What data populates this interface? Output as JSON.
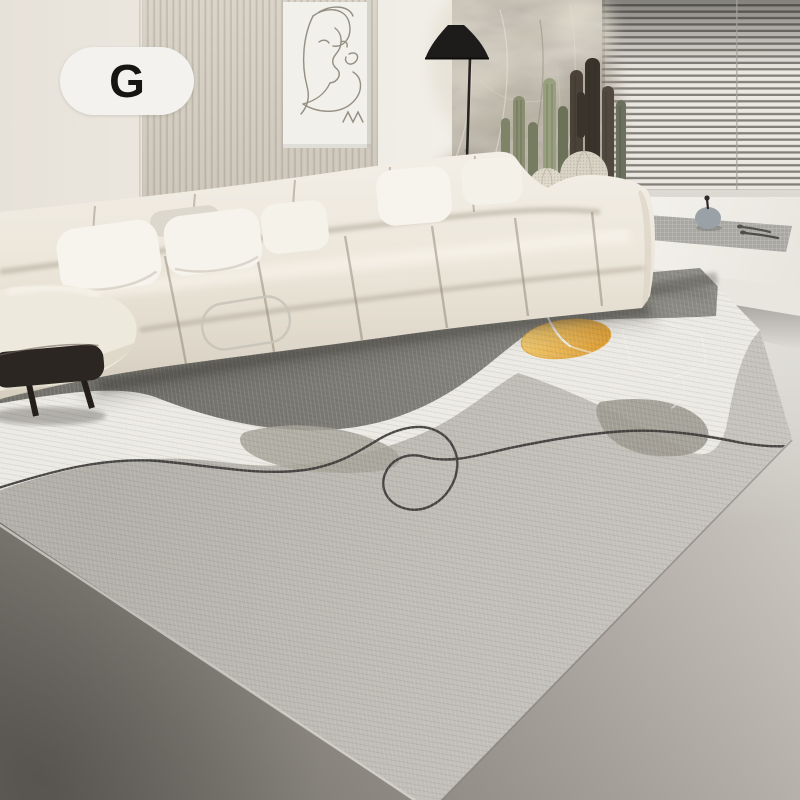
{
  "badge": {
    "label": "G",
    "background": "#f3f2ef",
    "text_color": "#171511"
  },
  "scene": {
    "description": "Minimalist living room product photo: cream modular sofa, large abstract gray area rug with mustard accent circle and black squiggle line, slatted wall panel with single-line portrait canvas, black cone floor lamp, pampas-grass wall hanging, cacti beside a window with horizontal blinds, white window bench with placemat and teapot",
    "wall": {
      "base": "#ece8e0",
      "slat_panel": "#dad4c9",
      "slat_line": "#c3bcb0",
      "seam": "#cfc9be"
    },
    "artwork": {
      "style": "single-line abstract portrait",
      "canvas": "#f2f0ea",
      "line": "#948e83"
    },
    "lamp": {
      "shade": "#1e1c1a",
      "pole": "#262422"
    },
    "blinds": {
      "light": "#ebe8e1",
      "dark": "#83807a"
    },
    "pampas": {
      "light": "#d8d1c2",
      "mid": "#b3ab9b",
      "dark": "#7a7365"
    },
    "cacti": {
      "green": "#8a8f72",
      "dark": "#3a332b",
      "gray_green": "#6b6f5e",
      "ball": "#d9d3c5"
    },
    "planter": {
      "color": "#efece5"
    },
    "bench": {
      "top": "#f4f2ed",
      "front": "#e9e6df",
      "placemat": "#a9a7a2",
      "teapot": "#9aa2a8",
      "cutlery": "#55534e"
    },
    "sofa": {
      "fabric": "#eee9dd",
      "highlight": "#f6f3ec",
      "shadow": "#d9d2c3",
      "pillow": "#f7f4ed"
    },
    "stool": {
      "color": "#2b2622"
    },
    "floor": {
      "light": "#dbd8d2",
      "mid": "#98948d",
      "dark": "#6b6862"
    },
    "rug": {
      "base": "#bcb9b2",
      "dark_section": "#75746d",
      "white_band": "#efede6",
      "accent_circle": "#e8a93c",
      "accent_circle_light": "#f2c766",
      "black_line": "#343230",
      "white_line": "#f4f2ec",
      "blob_sage": "#a5a296",
      "blob_gray": "#9c998f"
    }
  }
}
